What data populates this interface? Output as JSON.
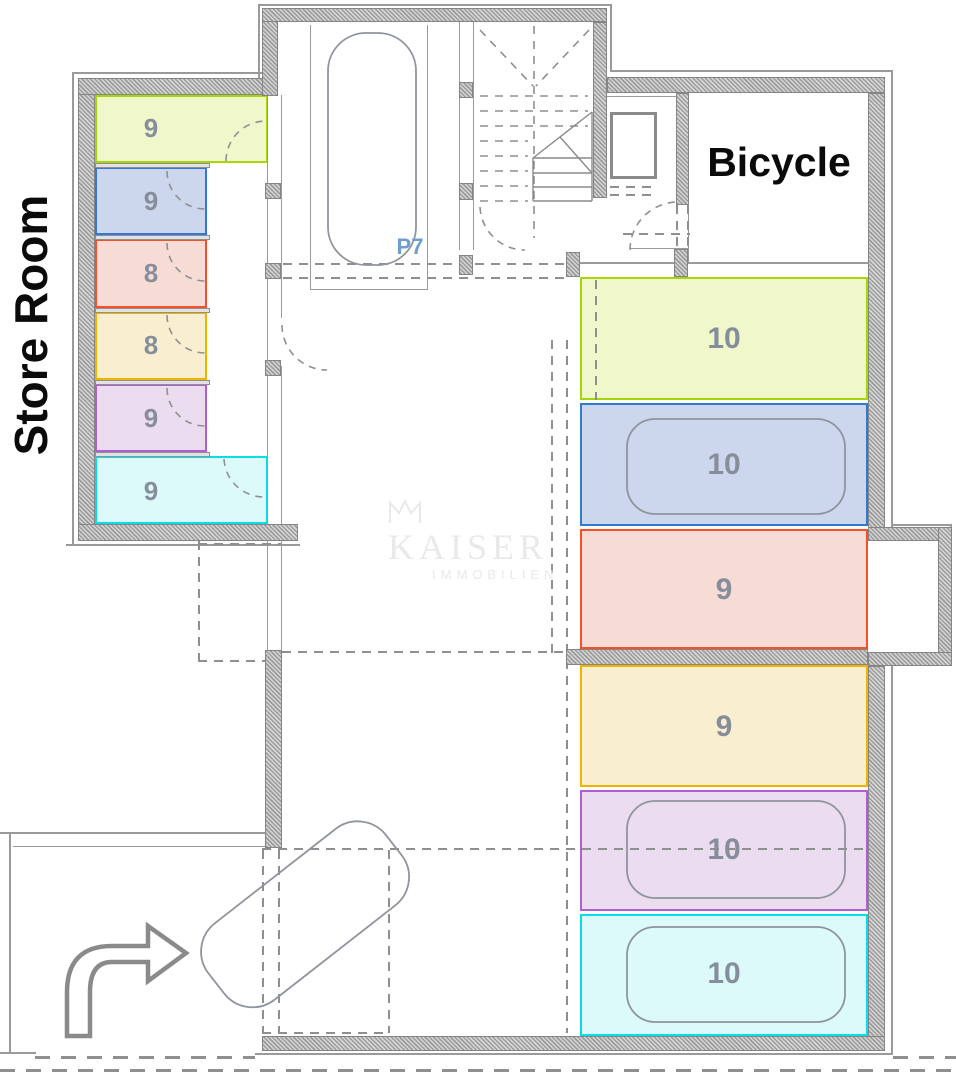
{
  "plan": {
    "store_room_title": "Store Room",
    "bicycle_label": "Bicycle",
    "p7_label": "P7",
    "watermark": {
      "brand": "KAISER",
      "subtitle": "IMMOBILIEN",
      "icon": "crown-icon"
    },
    "store_rooms": [
      {
        "id": "store-1",
        "area": "9",
        "color": "#a6d608",
        "fill": "#eff7cb"
      },
      {
        "id": "store-2",
        "area": "9",
        "color": "#3377dd",
        "fill": "#ccd6ec"
      },
      {
        "id": "store-3",
        "area": "8",
        "color": "#f4502a",
        "fill": "#f6dcd4"
      },
      {
        "id": "store-4",
        "area": "8",
        "color": "#f0b400",
        "fill": "#f9eed0"
      },
      {
        "id": "store-5",
        "area": "9",
        "color": "#b05fd0",
        "fill": "#ecdcf0"
      },
      {
        "id": "store-6",
        "area": "9",
        "color": "#06dde8",
        "fill": "#dcfafa"
      }
    ],
    "parking_spots": [
      {
        "id": "parking-1",
        "area": "10",
        "color": "#a6d608",
        "fill": "#eff7cb",
        "car": false
      },
      {
        "id": "parking-2",
        "area": "10",
        "color": "#2e7bd1",
        "fill": "#ccd6ec",
        "car": true
      },
      {
        "id": "parking-3",
        "area": "9",
        "color": "#f4502a",
        "fill": "#f6dcd4",
        "car": false
      },
      {
        "id": "parking-4",
        "area": "9",
        "color": "#f0b400",
        "fill": "#f9eed0",
        "car": false
      },
      {
        "id": "parking-5",
        "area": "10",
        "color": "#b05fd0",
        "fill": "#ecdcf0",
        "car": true
      },
      {
        "id": "parking-6",
        "area": "10",
        "color": "#06dde8",
        "fill": "#dcfafa",
        "car": true
      }
    ]
  }
}
